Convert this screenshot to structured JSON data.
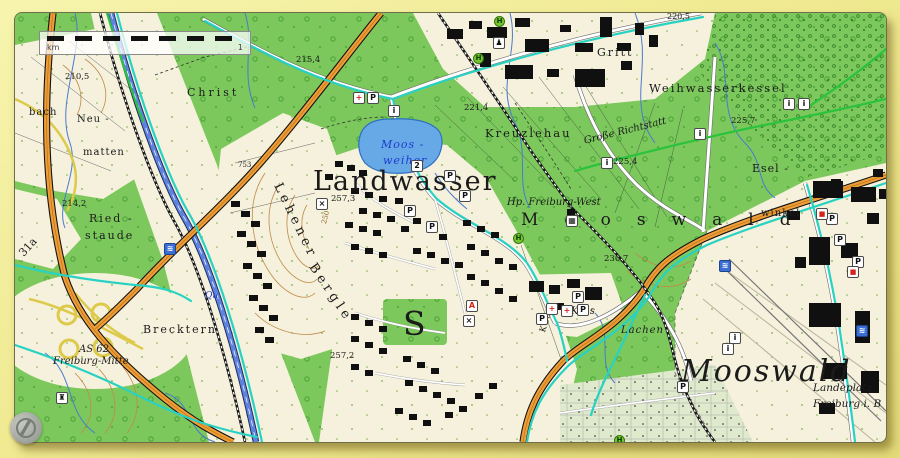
{
  "map": {
    "scale_bar": {
      "unit_label": "km",
      "end_label": "1"
    },
    "colors": {
      "forest": "#7cc85c",
      "field": "#f5f1dc",
      "lake": "#66a9e6",
      "autobahn_orange": "#ef9d38",
      "trunk_blue": "#5d82e0",
      "cycle_route_teal": "#28d2c3",
      "hiking_route_green": "#2bc33c",
      "contour_brown": "#c08a48",
      "building_black": "#101010"
    },
    "labels": [
      {
        "n": "label-landwasser",
        "t": "Landwasser",
        "x": 298,
        "y": 155,
        "s": 27,
        "c": "serif",
        "ls": 2
      },
      {
        "n": "label-mooswald-forest",
        "t": "Mooswald",
        "x": 506,
        "y": 199,
        "s": 17,
        "c": "serif",
        "ls": 26
      },
      {
        "n": "label-mooswald-district",
        "t": "Mooswald",
        "x": 666,
        "y": 344,
        "s": 30,
        "c": "italic",
        "ls": 2
      },
      {
        "n": "label-weihwasserkessel",
        "t": "Weihwasserkessel",
        "x": 634,
        "y": 70,
        "s": 11.5,
        "c": "",
        "ls": 2
      },
      {
        "n": "label-kreuzlehau",
        "t": "Kreuzlehau",
        "x": 470,
        "y": 115,
        "s": 11.5,
        "c": "",
        "ls": 2
      },
      {
        "n": "label-gritt",
        "t": "Gritt",
        "x": 582,
        "y": 34,
        "s": 11,
        "c": "",
        "ls": 2
      },
      {
        "n": "label-christ",
        "t": "Christ",
        "x": 172,
        "y": 74,
        "s": 11,
        "c": "",
        "ls": 3
      },
      {
        "n": "label-grosse-richtstatt",
        "t": "Große Richtstatt",
        "x": 568,
        "y": 124,
        "s": 10,
        "c": "italic",
        "r": -14
      },
      {
        "n": "label-esel",
        "t": "Esel -",
        "x": 737,
        "y": 150,
        "s": 11,
        "c": "",
        "ls": 1
      },
      {
        "n": "label-eselwinkel",
        "t": "winkel",
        "x": 746,
        "y": 196,
        "s": 10,
        "c": "",
        "ls": 1
      },
      {
        "n": "label-moosweiher-line1",
        "t": "Moos -",
        "x": 366,
        "y": 126,
        "s": 11,
        "c": "italic blue",
        "ls": 1
      },
      {
        "n": "label-moosweiher-line2",
        "t": "weiher",
        "x": 368,
        "y": 142,
        "s": 11,
        "c": "italic blue",
        "ls": 1
      },
      {
        "n": "label-hp-freiburg-west",
        "t": "Hp. Freiburg-West",
        "x": 492,
        "y": 185,
        "s": 10,
        "c": "italic"
      },
      {
        "n": "label-riedstaude-line1",
        "t": "Ried -",
        "x": 74,
        "y": 200,
        "s": 11,
        "c": "",
        "ls": 2
      },
      {
        "n": "label-riedstaude-line2",
        "t": "staude",
        "x": 70,
        "y": 217,
        "s": 11,
        "c": "",
        "ls": 2
      },
      {
        "n": "label-neumatten-line1",
        "t": "Neu -",
        "x": 62,
        "y": 102,
        "s": 10,
        "c": "",
        "ls": 1
      },
      {
        "n": "label-neumatten-line2",
        "t": "matten",
        "x": 68,
        "y": 135,
        "s": 10,
        "c": "",
        "ls": 1
      },
      {
        "n": "label-bach",
        "t": "bach",
        "x": 14,
        "y": 95,
        "s": 10,
        "c": "",
        "ls": 1
      },
      {
        "n": "label-brecktern",
        "t": "Brecktern",
        "x": 128,
        "y": 311,
        "s": 11,
        "c": "",
        "ls": 2
      },
      {
        "n": "label-as62-line1",
        "t": "AS 62",
        "x": 64,
        "y": 332,
        "s": 10,
        "c": "italic"
      },
      {
        "n": "label-as62-line2",
        "t": "Freiburg-Mitte",
        "x": 38,
        "y": 344,
        "s": 10,
        "c": "italic"
      },
      {
        "n": "label-lachen",
        "t": "Lachen",
        "x": 606,
        "y": 313,
        "s": 10,
        "c": "italic",
        "ls": 1
      },
      {
        "n": "label-krhs",
        "t": "Krhs",
        "x": 556,
        "y": 294,
        "s": 10,
        "c": "italic"
      },
      {
        "n": "label-landeplatz-line1",
        "t": "Landeplatz",
        "x": 798,
        "y": 370,
        "s": 10.5,
        "c": "italic"
      },
      {
        "n": "label-landeplatz-line2",
        "t": "Freiburg i. B",
        "x": 798,
        "y": 386,
        "s": 10.5,
        "c": "italic"
      },
      {
        "n": "label-school-s",
        "t": "S",
        "x": 388,
        "y": 294,
        "s": 33,
        "c": ""
      },
      {
        "n": "label-lehener",
        "t": "Lehener",
        "x": 268,
        "y": 168,
        "s": 13,
        "c": "",
        "ls": 4,
        "r": 64
      },
      {
        "n": "label-bergle",
        "t": "Bergle",
        "x": 302,
        "y": 248,
        "s": 13,
        "c": "",
        "ls": 4,
        "r": 56
      },
      {
        "n": "label-road-31a",
        "t": "31a",
        "x": 2,
        "y": 238,
        "s": 11,
        "c": "",
        "r": -48
      },
      {
        "n": "label-road-k9860",
        "t": "K 9860",
        "x": 524,
        "y": 318,
        "s": 8.5,
        "c": "",
        "r": -72
      },
      {
        "n": "label-stream-qu",
        "t": "Qu",
        "x": 190,
        "y": 279,
        "s": 9,
        "c": "italic blue"
      },
      {
        "n": "spot-height",
        "t": "210,5",
        "x": 50,
        "y": 60,
        "s": 8.5,
        "c": ""
      },
      {
        "n": "spot-height",
        "t": "215,4",
        "x": 281,
        "y": 43,
        "s": 8.5,
        "c": ""
      },
      {
        "n": "spot-height",
        "t": "221,4",
        "x": 449,
        "y": 91,
        "s": 8.5,
        "c": ""
      },
      {
        "n": "spot-height",
        "t": "225,7",
        "x": 716,
        "y": 104,
        "s": 8.5,
        "c": ""
      },
      {
        "n": "spot-height",
        "t": "225,4",
        "x": 598,
        "y": 145,
        "s": 8.5,
        "c": ""
      },
      {
        "n": "spot-height",
        "t": "230,7",
        "x": 589,
        "y": 242,
        "s": 8.5,
        "c": ""
      },
      {
        "n": "spot-height",
        "t": "214,2",
        "x": 47,
        "y": 187,
        "s": 8.5,
        "c": ""
      },
      {
        "n": "spot-height",
        "t": "257,3",
        "x": 316,
        "y": 182,
        "s": 8.5,
        "c": ""
      },
      {
        "n": "spot-height",
        "t": "257,2",
        "x": 315,
        "y": 339,
        "s": 8.5,
        "c": ""
      },
      {
        "n": "spot-height",
        "t": "753",
        "x": 223,
        "y": 149,
        "s": 7,
        "c": ""
      },
      {
        "n": "spot-height",
        "t": "220,5",
        "x": 652,
        "y": 0,
        "s": 8,
        "c": ""
      },
      {
        "n": "contour-label",
        "t": "250",
        "x": 306,
        "y": 210,
        "s": 7,
        "c": "contour",
        "r": -75
      }
    ],
    "icons": [
      {
        "n": "hospital-icon",
        "g": "+",
        "x": 338,
        "y": 79,
        "c": "red"
      },
      {
        "n": "parking-icon",
        "g": "P",
        "x": 352,
        "y": 79,
        "c": ""
      },
      {
        "n": "info-icon",
        "g": "i",
        "x": 373,
        "y": 92,
        "c": ""
      },
      {
        "n": "parking-icon",
        "g": "P",
        "x": 429,
        "y": 157,
        "c": ""
      },
      {
        "n": "parking-icon",
        "g": "P",
        "x": 444,
        "y": 177,
        "c": ""
      },
      {
        "n": "parking-icon",
        "g": "P",
        "x": 389,
        "y": 192,
        "c": ""
      },
      {
        "n": "parking-icon",
        "g": "P",
        "x": 411,
        "y": 208,
        "c": ""
      },
      {
        "n": "parking-icon",
        "g": "P",
        "x": 521,
        "y": 300,
        "c": ""
      },
      {
        "n": "parking-icon",
        "g": "P",
        "x": 557,
        "y": 278,
        "c": ""
      },
      {
        "n": "parking-icon",
        "g": "P",
        "x": 562,
        "y": 291,
        "c": ""
      },
      {
        "n": "parking-icon",
        "g": "P",
        "x": 811,
        "y": 200,
        "c": ""
      },
      {
        "n": "parking-icon",
        "g": "P",
        "x": 819,
        "y": 221,
        "c": ""
      },
      {
        "n": "parking-icon",
        "g": "P",
        "x": 837,
        "y": 243,
        "c": ""
      },
      {
        "n": "parking-icon",
        "g": "P",
        "x": 662,
        "y": 368,
        "c": ""
      },
      {
        "n": "bus-stop-icon",
        "g": "H",
        "x": 458,
        "y": 40,
        "c": "bus"
      },
      {
        "n": "bus-stop-icon",
        "g": "H",
        "x": 479,
        "y": 3,
        "c": "bus"
      },
      {
        "n": "bus-stop-icon",
        "g": "H",
        "x": 498,
        "y": 220,
        "c": "bus"
      },
      {
        "n": "bus-stop-icon",
        "g": "H",
        "x": 599,
        "y": 422,
        "c": "bus"
      },
      {
        "n": "monument-icon",
        "g": "i",
        "x": 768,
        "y": 85,
        "c": ""
      },
      {
        "n": "monument-icon",
        "g": "i",
        "x": 783,
        "y": 85,
        "c": ""
      },
      {
        "n": "monument-icon",
        "g": "i",
        "x": 714,
        "y": 319,
        "c": ""
      },
      {
        "n": "monument-icon",
        "g": "i",
        "x": 707,
        "y": 330,
        "c": ""
      },
      {
        "n": "monument-icon",
        "g": "i",
        "x": 586,
        "y": 144,
        "c": ""
      },
      {
        "n": "monument-icon",
        "g": "i",
        "x": 679,
        "y": 115,
        "c": ""
      },
      {
        "n": "hiker-icon",
        "g": "♟",
        "x": 478,
        "y": 24,
        "c": ""
      },
      {
        "n": "station-icon",
        "g": "▦",
        "x": 551,
        "y": 202,
        "c": ""
      },
      {
        "n": "red-cross-icon",
        "g": "+",
        "x": 531,
        "y": 290,
        "c": "red"
      },
      {
        "n": "red-cross-icon",
        "g": "+",
        "x": 546,
        "y": 292,
        "c": "red"
      },
      {
        "n": "pharmacy-icon",
        "g": "A",
        "x": 451,
        "y": 287,
        "c": "red"
      },
      {
        "n": "church-icon",
        "g": "×",
        "x": 301,
        "y": 185,
        "c": ""
      },
      {
        "n": "church-icon",
        "g": "×",
        "x": 448,
        "y": 302,
        "c": ""
      },
      {
        "n": "swimming-icon",
        "g": "≋",
        "x": 149,
        "y": 230,
        "c": "bluebg"
      },
      {
        "n": "swimming-icon",
        "g": "≋",
        "x": 704,
        "y": 247,
        "c": "bluebg"
      },
      {
        "n": "swimming-icon",
        "g": "≋",
        "x": 841,
        "y": 312,
        "c": "bluebg"
      },
      {
        "n": "tower-icon",
        "g": "♜",
        "x": 41,
        "y": 379,
        "c": ""
      },
      {
        "n": "shop-icon",
        "g": "■",
        "x": 801,
        "y": 195,
        "c": "shopred"
      },
      {
        "n": "shop-icon",
        "g": "■",
        "x": 832,
        "y": 253,
        "c": "shopred"
      },
      {
        "n": "lake-marker-icon",
        "g": "2",
        "x": 396,
        "y": 147,
        "c": ""
      }
    ]
  }
}
